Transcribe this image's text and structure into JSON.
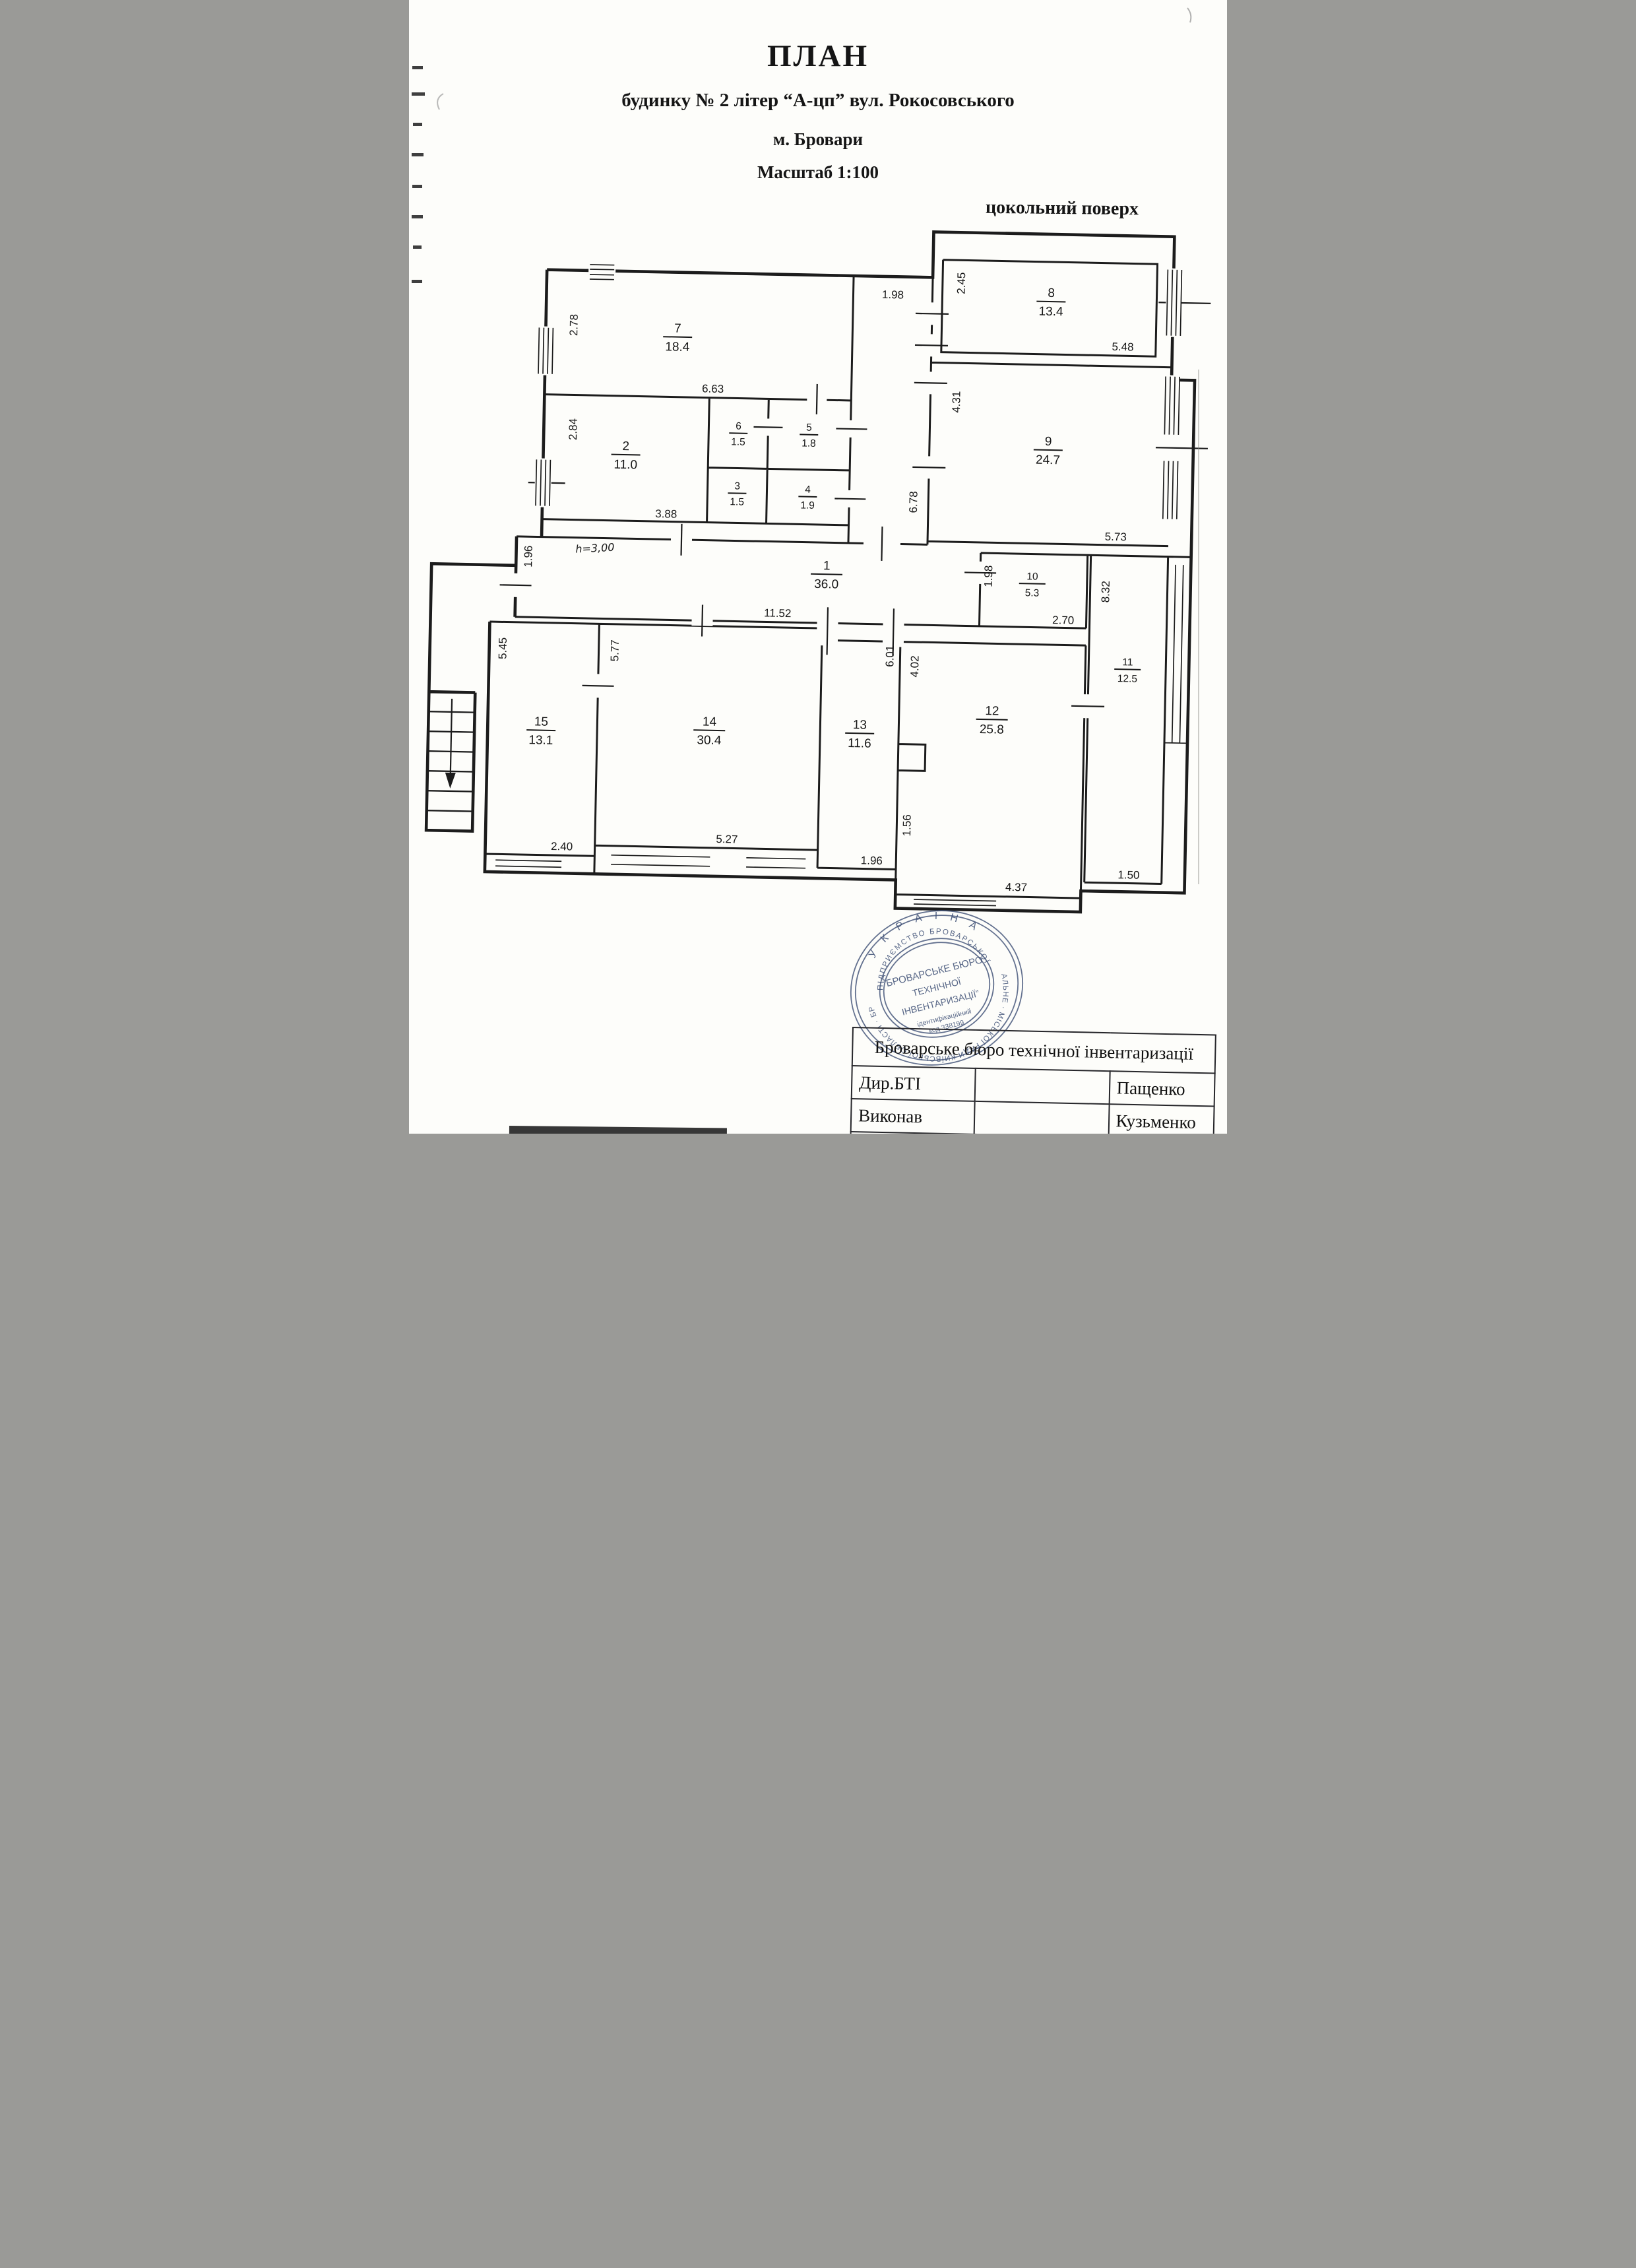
{
  "header": {
    "title": "ПЛАН",
    "subtitle": "будинку № 2 літер “А-цп” вул. Рокосовського",
    "city": "м. Бровари",
    "scale": "Масштаб 1:100",
    "floor": "цокольний поверх"
  },
  "plan": {
    "height_note": "h=3,00",
    "rooms": [
      {
        "n": "1",
        "a": "36.0"
      },
      {
        "n": "2",
        "a": "11.0"
      },
      {
        "n": "3",
        "a": "1.5"
      },
      {
        "n": "4",
        "a": "1.9"
      },
      {
        "n": "5",
        "a": "1.8"
      },
      {
        "n": "6",
        "a": "1.5"
      },
      {
        "n": "7",
        "a": "18.4"
      },
      {
        "n": "8",
        "a": "13.4"
      },
      {
        "n": "9",
        "a": "24.7"
      },
      {
        "n": "10",
        "a": "5.3"
      },
      {
        "n": "11",
        "a": "12.5"
      },
      {
        "n": "12",
        "a": "25.8"
      },
      {
        "n": "13",
        "a": "11.6"
      },
      {
        "n": "14",
        "a": "30.4"
      },
      {
        "n": "15",
        "a": "13.1"
      }
    ],
    "dims": [
      "2.78",
      "6.63",
      "2.84",
      "3.88",
      "1.98",
      "2.45",
      "5.48",
      "4.31",
      "6.78",
      "5.73",
      "1.96",
      "11.52",
      "1.98",
      "2.70",
      "8.32",
      "5.45",
      "5.77",
      "6.01",
      "4.02",
      "2.40",
      "5.27",
      "1.96",
      "1.56",
      "4.37",
      "1.50"
    ]
  },
  "stamp": {
    "country": "У К Р А Ї Н А",
    "ring_top": "ПІДПРИЄМСТВО  БРОВАРСЬКОЇ",
    "ring_bottom": "КОМУНАЛЬНЕ · МІСЬКОЇ РАДИ КИЇВСЬКОЇ ОБЛАСТІ · БРОВАРИ",
    "center1": "“БРОВАРСЬКЕ БЮРО",
    "center2": "ТЕХНІЧНОЇ",
    "center3": "ІНВЕНТАРИЗАЦІЇ”",
    "code1": "ідентифікаційний",
    "code2": "код 338199"
  },
  "table": {
    "header": "Броварське  бюро технічної інвентаризації",
    "rows": [
      {
        "role": "Дир.БТІ",
        "name": "Пащенко"
      },
      {
        "role": "Виконав",
        "name": "Кузьменко"
      },
      {
        "role": "Перевірив",
        "name": "Кащенко"
      }
    ]
  }
}
